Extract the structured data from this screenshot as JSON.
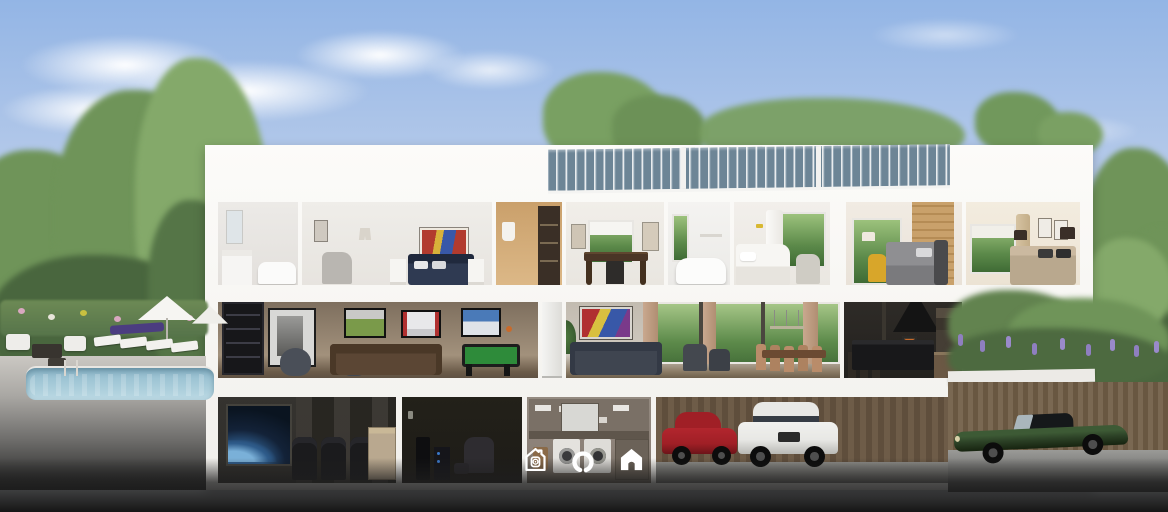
{
  "ui": {
    "icon_bar": {
      "buttons": [
        {
          "id": "security",
          "icon": "house-security-icon"
        },
        {
          "id": "assistant",
          "icon": "assistant-ring-icon"
        },
        {
          "id": "home",
          "icon": "home-icon"
        }
      ]
    }
  },
  "scene": {
    "type": "3d-house-cutaway-render",
    "floors": [
      {
        "name": "upper",
        "rooms": [
          "marble-bathroom",
          "master-bedroom",
          "walk-in-closet",
          "home-office",
          "bathroom",
          "white-bedroom",
          "brick-wall-bedroom",
          "beige-bedroom"
        ]
      },
      {
        "name": "main",
        "rooms": [
          "media-game-room",
          "living-room",
          "dining-area",
          "kitchen"
        ]
      },
      {
        "name": "basement",
        "rooms": [
          "home-theater",
          "listening-lounge",
          "laundry-room",
          "garage"
        ]
      }
    ],
    "exterior": [
      "swimming-pool",
      "sun-loungers",
      "patio-umbrellas",
      "flower-hedge",
      "solar-panels",
      "garden-with-lavender",
      "wood-retaining-wall",
      "red-sedan",
      "white-suv",
      "green-classic-convertible"
    ]
  },
  "colors": {
    "sky_top": "#93b5e5",
    "sky_horizon": "#dce6f3",
    "cloud_white": "#ffffff",
    "tree_dark": "#49663e",
    "tree_mid": "#6f9459",
    "tree_light": "#84a96a",
    "house_white": "#f8f7f4",
    "solar_blue": "#6d8596",
    "pool_water": "#a9cdda",
    "closet_warm": "#dcb887",
    "sofa_brown": "#5b4634",
    "pool_table_green": "#2e8b3a",
    "bed_navy": "#2f3a52",
    "kitchen_dark": "#23211e",
    "theater_dark": "#2f2d2a",
    "wood_fence": "#6e5c48",
    "garden_lavender": "#8f7fc0",
    "car_red": "#a01f26",
    "car_white": "#e8e8e5",
    "car_green": "#2c4126",
    "icon_white": "#ffffff",
    "foreground_dark": "#161616"
  }
}
